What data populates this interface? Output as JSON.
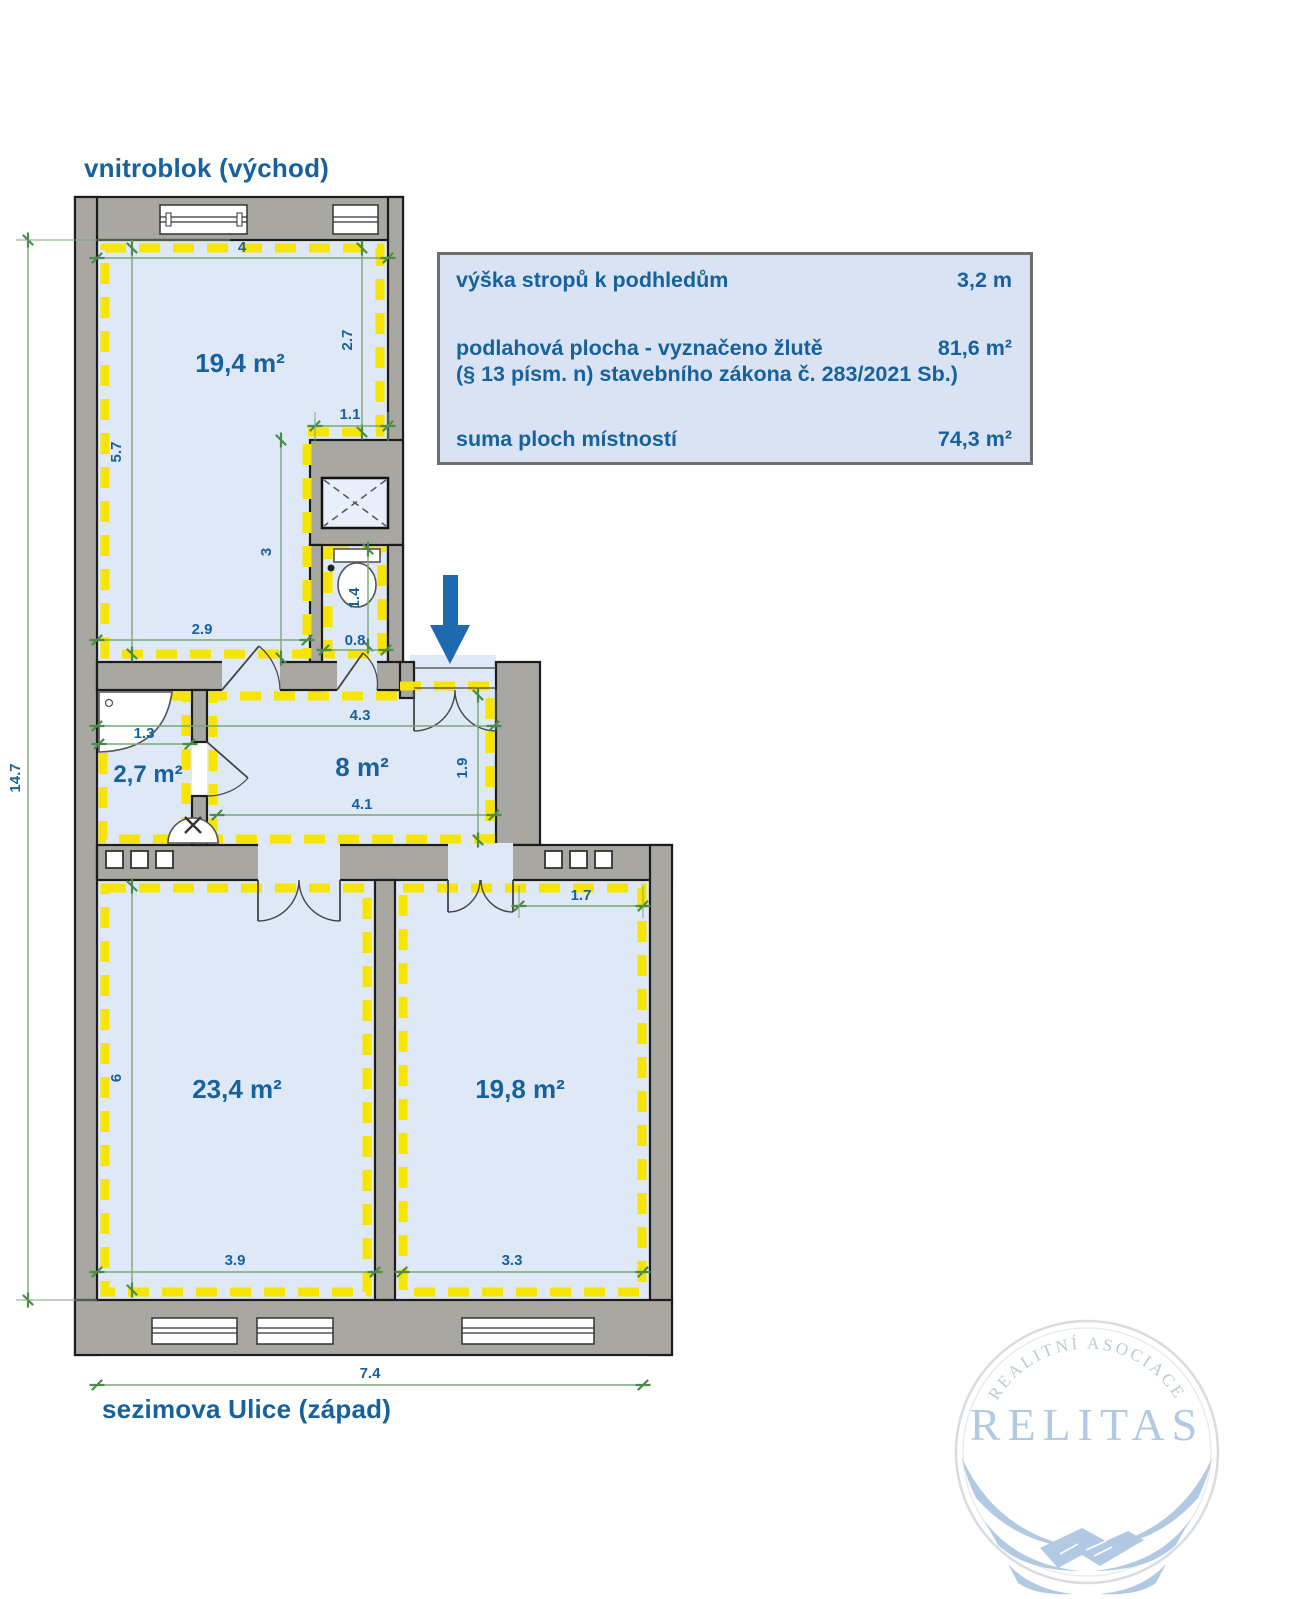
{
  "labels": {
    "top_street": "vnitroblok (východ)",
    "bottom_street": "sezimova Ulice (západ)"
  },
  "info_box": {
    "ceiling_label": "výška stropů k podhledům",
    "ceiling_value": "3,2 m",
    "floor_area_label": "podlahová plocha - vyznačeno žlutě",
    "floor_area_value": "81,6 m²",
    "floor_area_note": "(§ 13 písm. n) stavebního zákona č. 283/2021 Sb.)",
    "rooms_sum_label": "suma ploch místností",
    "rooms_sum_value": "74,3 m²"
  },
  "rooms": {
    "top": "19,4 m²",
    "bath": "2,7 m²",
    "hall": "8 m²",
    "bottom_left": "23,4 m²",
    "bottom_right": "19,8 m²"
  },
  "dims": {
    "top_width": "4",
    "left_upper": "5.7",
    "right_upper": "2.7",
    "notch": "1.1",
    "inner_vert": "3",
    "room_top_bottom": "2.9",
    "wc_height": "1.4",
    "wc_width": "0.8",
    "bath_width": "1.3",
    "hall_top": "4.3",
    "hall_bottom": "4.1",
    "entry_depth": "1.9",
    "right_room_top": "1.7",
    "left_room_height": "6",
    "bottom_left_width": "3.9",
    "bottom_right_width": "3.3",
    "total_width": "7.4",
    "total_height": "14.7"
  },
  "logo": {
    "arc": "REALITNÍ ASOCIACE",
    "name": "RELITAS"
  },
  "colors": {
    "wall_gray": "#a8a7a2",
    "floor_blue": "#dfe8f6",
    "highlight_yellow": "#f6e402",
    "dimension_green": "#78a878",
    "text_blue": "#17619c",
    "entry_arrow_blue": "#1d6ab0",
    "logo_blue": "#abc5e1"
  }
}
